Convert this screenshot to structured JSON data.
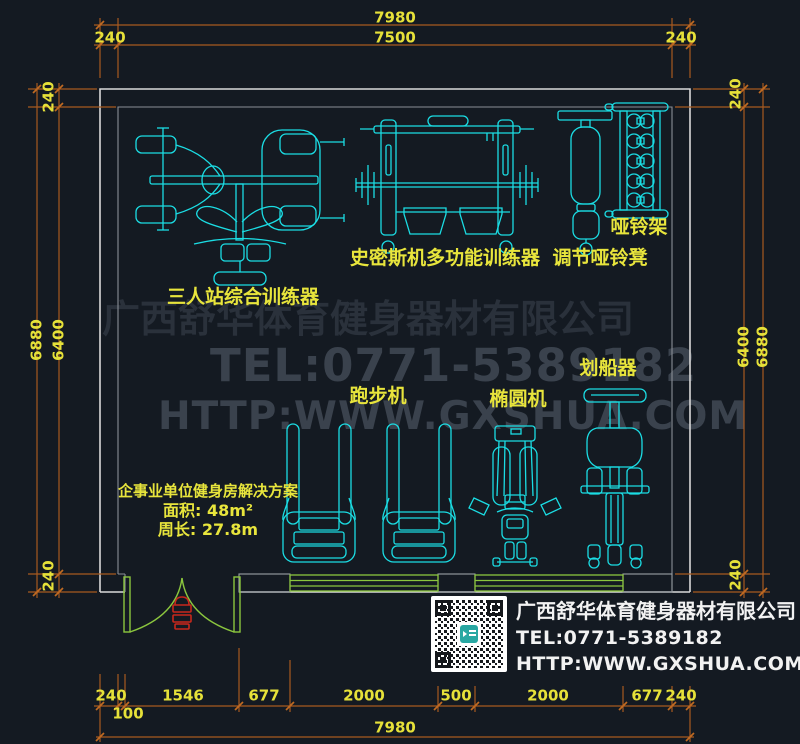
{
  "dims": {
    "top_total": "7980",
    "top_inner": "7500",
    "top_left_offset": "240",
    "top_right_offset": "240",
    "left_outer": "6880",
    "left_inner": "6400",
    "left_top_offset": "240",
    "left_bottom_offset": "240",
    "right_inner": "6400",
    "right_outer": "6880",
    "right_top_offset": "240",
    "right_bottom_offset": "240",
    "bottom_segments": [
      "240",
      "1546",
      "677",
      "2000",
      "500",
      "2000",
      "677",
      "240"
    ],
    "bottom_jamb": "100",
    "bottom_total": "7980"
  },
  "equipment_labels": {
    "multi_station": "三人站综合训练器",
    "smith_machine": "史密斯机多功能训练器",
    "dumbbell_rack": "哑铃架",
    "dumbbell_bench": "调节哑铃凳",
    "treadmill": "跑步机",
    "elliptical": "椭圆机",
    "rower": "划船器"
  },
  "solution": {
    "title": "企事业单位健身房解决方案",
    "area": "面积: 48m²",
    "perimeter": "周长: 27.8m"
  },
  "watermark": {
    "company": "广西舒华体育健身器材有限公司",
    "tel": "TEL:0771-5389182",
    "url": "HTTP:WWW.GXSHUA.COM"
  },
  "info_panel": {
    "company": "广西舒华体育健身器材有限公司",
    "tel": "TEL:0771-5389182",
    "url": "HTTP:WWW.GXSHUA.COM"
  },
  "colors": {
    "background": "#141a22",
    "equipment_line": "#1bdde4",
    "dimension_line": "#a85a20",
    "dimension_text": "#e6e139",
    "wall_outer": "#d9d9d9",
    "wall_inner": "#8a8f96",
    "door_window": "#8bc63e",
    "door_symbol": "#c8281c",
    "watermark_dark": "#2a313b",
    "watermark_light": "#3a424d",
    "panel_text": "#f2f2f2"
  }
}
